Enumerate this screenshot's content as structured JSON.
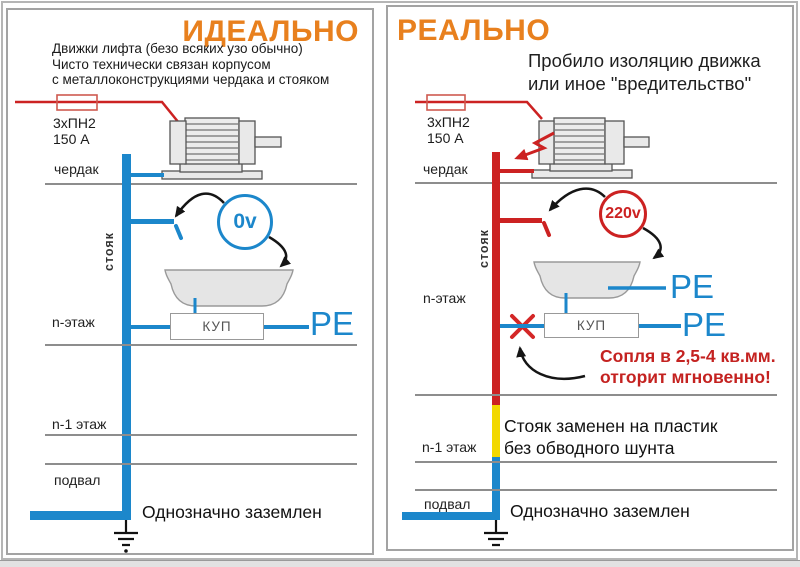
{
  "colors": {
    "accent_orange": "#e8801e",
    "wire_blue": "#1c87cb",
    "wire_red": "#cc2222",
    "plastic_yellow": "#f2d800"
  },
  "ideal": {
    "title": "ИДЕАЛЬНО",
    "description_lines": [
      "Движки лифта (безо всяких узо обычно)",
      "Чисто технически связан корпусом",
      "с металлоконструкциями чердака и стояком"
    ],
    "fuse_label_lines": [
      "3хПН2",
      "150 А"
    ],
    "labels": {
      "attic": "чердак",
      "riser": "стояк",
      "floor_n": "n-этаж",
      "floor_n_minus_1": "n-1 этаж",
      "basement": "подвал"
    },
    "voltmeter": "0v",
    "kup": "КУП",
    "pe_kup": "PE",
    "grounded_note": "Однозначно заземлен"
  },
  "real": {
    "title": "РЕАЛЬНО",
    "description_lines": [
      "Пробило изоляцию движка",
      "или иное \"вредительство\""
    ],
    "fuse_label_lines": [
      "3хПН2",
      "150 А"
    ],
    "labels": {
      "attic": "чердак",
      "riser": "стояк",
      "floor_n": "n-этаж",
      "floor_n_minus_1": "n-1 этаж",
      "basement": "подвал"
    },
    "voltmeter": "220v",
    "kup": "КУП",
    "pe_tub": "PE",
    "pe_kup": "PE",
    "warning_lines": [
      "Сопля в 2,5-4 кв.мм.",
      "отгорит мгновенно!"
    ],
    "plastic_note_lines": [
      "Стояк заменен на пластик",
      "без обводного шунта"
    ],
    "grounded_note": "Однозначно заземлен"
  }
}
